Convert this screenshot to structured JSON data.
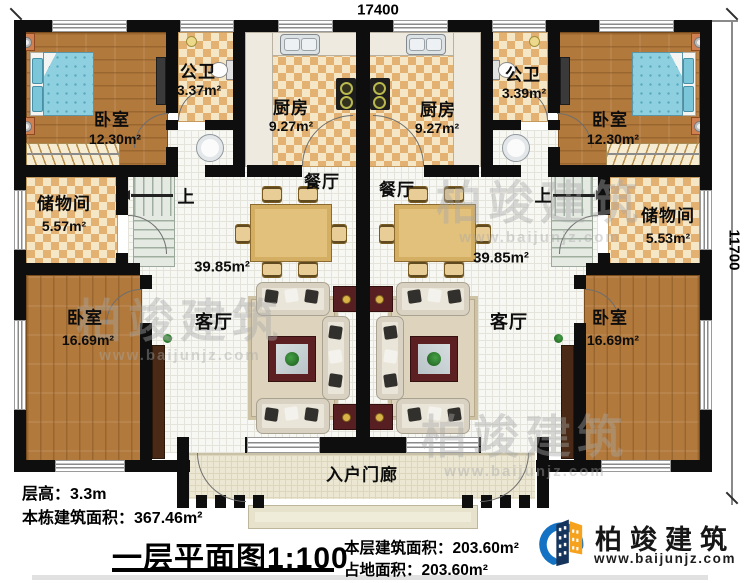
{
  "dimensions": {
    "top": "17400",
    "right": "11700"
  },
  "rooms": {
    "bedroom_top_left": {
      "name": "卧室",
      "area": "12.30m²"
    },
    "bath_left": {
      "name": "公卫",
      "area": "3.37m²"
    },
    "kitchen_left": {
      "name": "厨房",
      "area": "9.27m²"
    },
    "kitchen_right": {
      "name": "厨房",
      "area": "9.27m²"
    },
    "bath_right": {
      "name": "公卫",
      "area": "3.39m²"
    },
    "bedroom_top_right": {
      "name": "卧室",
      "area": "12.30m²"
    },
    "storage_left": {
      "name": "储物间",
      "area": "5.57m²"
    },
    "storage_right": {
      "name": "储物间",
      "area": "5.53m²"
    },
    "dining_left": {
      "name": "餐厅"
    },
    "dining_right": {
      "name": "餐厅"
    },
    "hall_left": {
      "area": "39.85m²"
    },
    "hall_right": {
      "area": "39.85m²"
    },
    "living_left": {
      "name": "客厅"
    },
    "living_right": {
      "name": "客厅"
    },
    "bedroom_bottom_left": {
      "name": "卧室",
      "area": "16.69m²"
    },
    "bedroom_bottom_right": {
      "name": "卧室",
      "area": "16.69m²"
    },
    "porch": {
      "name": "入户门廊"
    }
  },
  "stairs": {
    "up_label": "上"
  },
  "title_block": {
    "floor_height": "层高：3.3m",
    "building_area": "本栋建筑面积：367.46m²",
    "plan_title": "一层平面图1:100",
    "floor_area": "本层建筑面积：203.60m²",
    "footprint_area": "占地面积：203.60m²"
  },
  "logo": {
    "brand": "柏竣建筑",
    "url": "www.baijunjz.com"
  },
  "watermark": {
    "brand": "柏竣建筑",
    "url": "www.baijunjz.com"
  },
  "colors": {
    "wall": "#0e0e0e",
    "wood_floor": "#b2793c",
    "checker_dark": "#e3b273",
    "checker_light": "#f5e7c6",
    "bed_blue": "#8fd0e0",
    "maroon": "#5c2022",
    "logo_blue": "#1472c4",
    "logo_orange": "#f6a21c",
    "logo_navy": "#16355c"
  }
}
